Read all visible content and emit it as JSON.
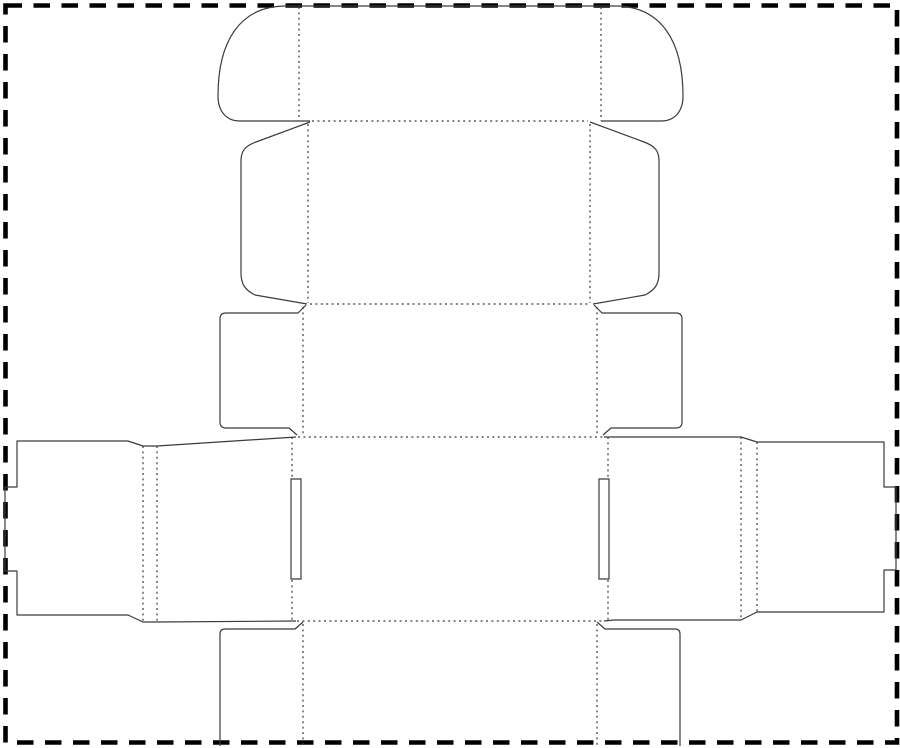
{
  "canvas": {
    "width": 900,
    "height": 748,
    "viewbox": "0 0 900 748",
    "background": "#ffffff"
  },
  "style": {
    "cut_color": "#3b3b3b",
    "fold_color": "#3b3b3b",
    "border_color": "#000000",
    "cut_width": "1.2",
    "fold_width": "1.2",
    "border_width": "4.6",
    "fold_dash": "2 3.4",
    "border_dash": "16.5 11.5"
  },
  "dieline": {
    "border": "M5.5,5.5 H897 V742.5 H5.5 Z",
    "cut": {
      "tuck_flap": "M310,121 H240 C226,121 218,111 218,96 C218,41 240,6 286,6 H615 C661,6 683,41 683,96 C683,111 675,121 661,121 H601",
      "lid_dust_flap_left": "M310,122 L256,142 C245,146 241,151 241,161 V273 C241,284 245,290 255,295 L307,304",
      "lid_dust_flap_right": "M590,122 L644,142 C655,146 659,151 659,161 V273 C659,284 655,290 645,295 L593,304",
      "front_tab_left": "M306,305 L298,313 H226 Q220,313 220,319 V422 Q220,428 226,428 H289 L297,435",
      "front_tab_right": "M594,305 L602,313 H676 Q682,313 682,319 V422 Q682,428 676,428 H611 L603,435",
      "body_strip_left": "M296,437 L157,446 H143 L128,441 H17 V487 H5 V571 H17 V615 H128 L143,622 H157 L296,621",
      "body_strip_right": "M604,437 H741 L757,442 H884 V487 H896 V570 H884 V612 H757 L741,620 H614 L604,621",
      "lock_slit_left": "M291,479 H301 V579 H291 Z",
      "lock_slit_right": "M599,479 H609 V579 H599 Z",
      "bottom_flap_left": "M303,622 L295,629 H225 Q220,629 220,634 V746",
      "bottom_flap_right": "M597,622 L605,629 H675 Q680,629 680,634 V746"
    },
    "fold": {
      "tuck_flap_left": "M299,7 V121",
      "tuck_flap_right": "M601,7 V121",
      "tuck_to_lid": "M312,121 H588",
      "lid_side_left": "M308,124 V303",
      "lid_side_right": "M590,124 V303",
      "lid_to_front": "M310,304 H590",
      "front_side_left": "M303,307 V435",
      "front_side_right": "M597,307 V435",
      "front_to_body": "M298,437 H603",
      "glue_crease_a": "M143,446 V622",
      "glue_crease_b": "M157,446 V622",
      "right_crease_a": "M741,437 V620",
      "right_crease_b": "M757,442 V612",
      "body_center_left": "M292,437 V478 M292,580 V621",
      "body_center_right": "M608,437 V478 M608,580 V621",
      "body_to_bottom": "M297,621 H603",
      "bottom_side_left": "M303,624 V746",
      "bottom_side_right": "M597,624 V746"
    }
  }
}
